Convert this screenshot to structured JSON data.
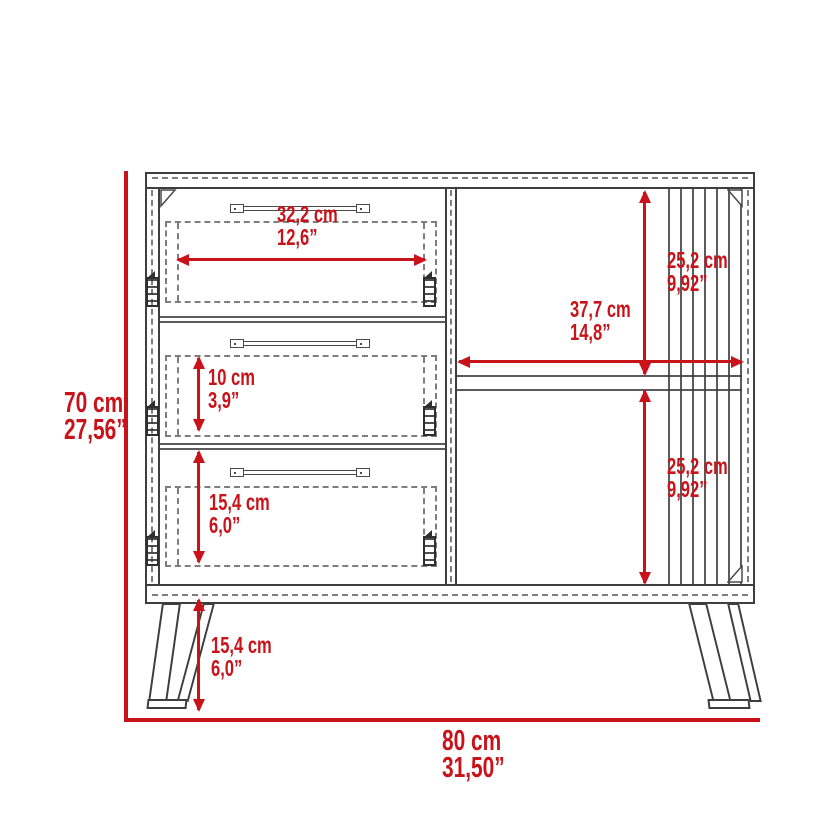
{
  "diagram": "furniture-dimension-drawing",
  "colors": {
    "dimension_red": "#c9131a",
    "line_gray": "#3e3e3e"
  },
  "labels": {
    "overall_height": {
      "cm": "70 cm",
      "inch": "27,56”"
    },
    "overall_width": {
      "cm": "80 cm",
      "inch": "31,50”"
    },
    "top_drawer_width": {
      "cm": "32,2 cm",
      "inch": "12,6”"
    },
    "middle_drawer_height": {
      "cm": "10 cm",
      "inch": "3,9”"
    },
    "bottom_drawer_height": {
      "cm": "15,4 cm",
      "inch": "6,0”"
    },
    "right_compartment_width": {
      "cm": "37,7 cm",
      "inch": "14,8”"
    },
    "right_upper_compartment_height": {
      "cm": "25,2 cm",
      "inch": "9,92”"
    },
    "right_lower_compartment_height": {
      "cm": "25,2 cm",
      "inch": "9,92”"
    },
    "leg_height": {
      "cm": "15,4 cm",
      "inch": "6,0”"
    }
  }
}
